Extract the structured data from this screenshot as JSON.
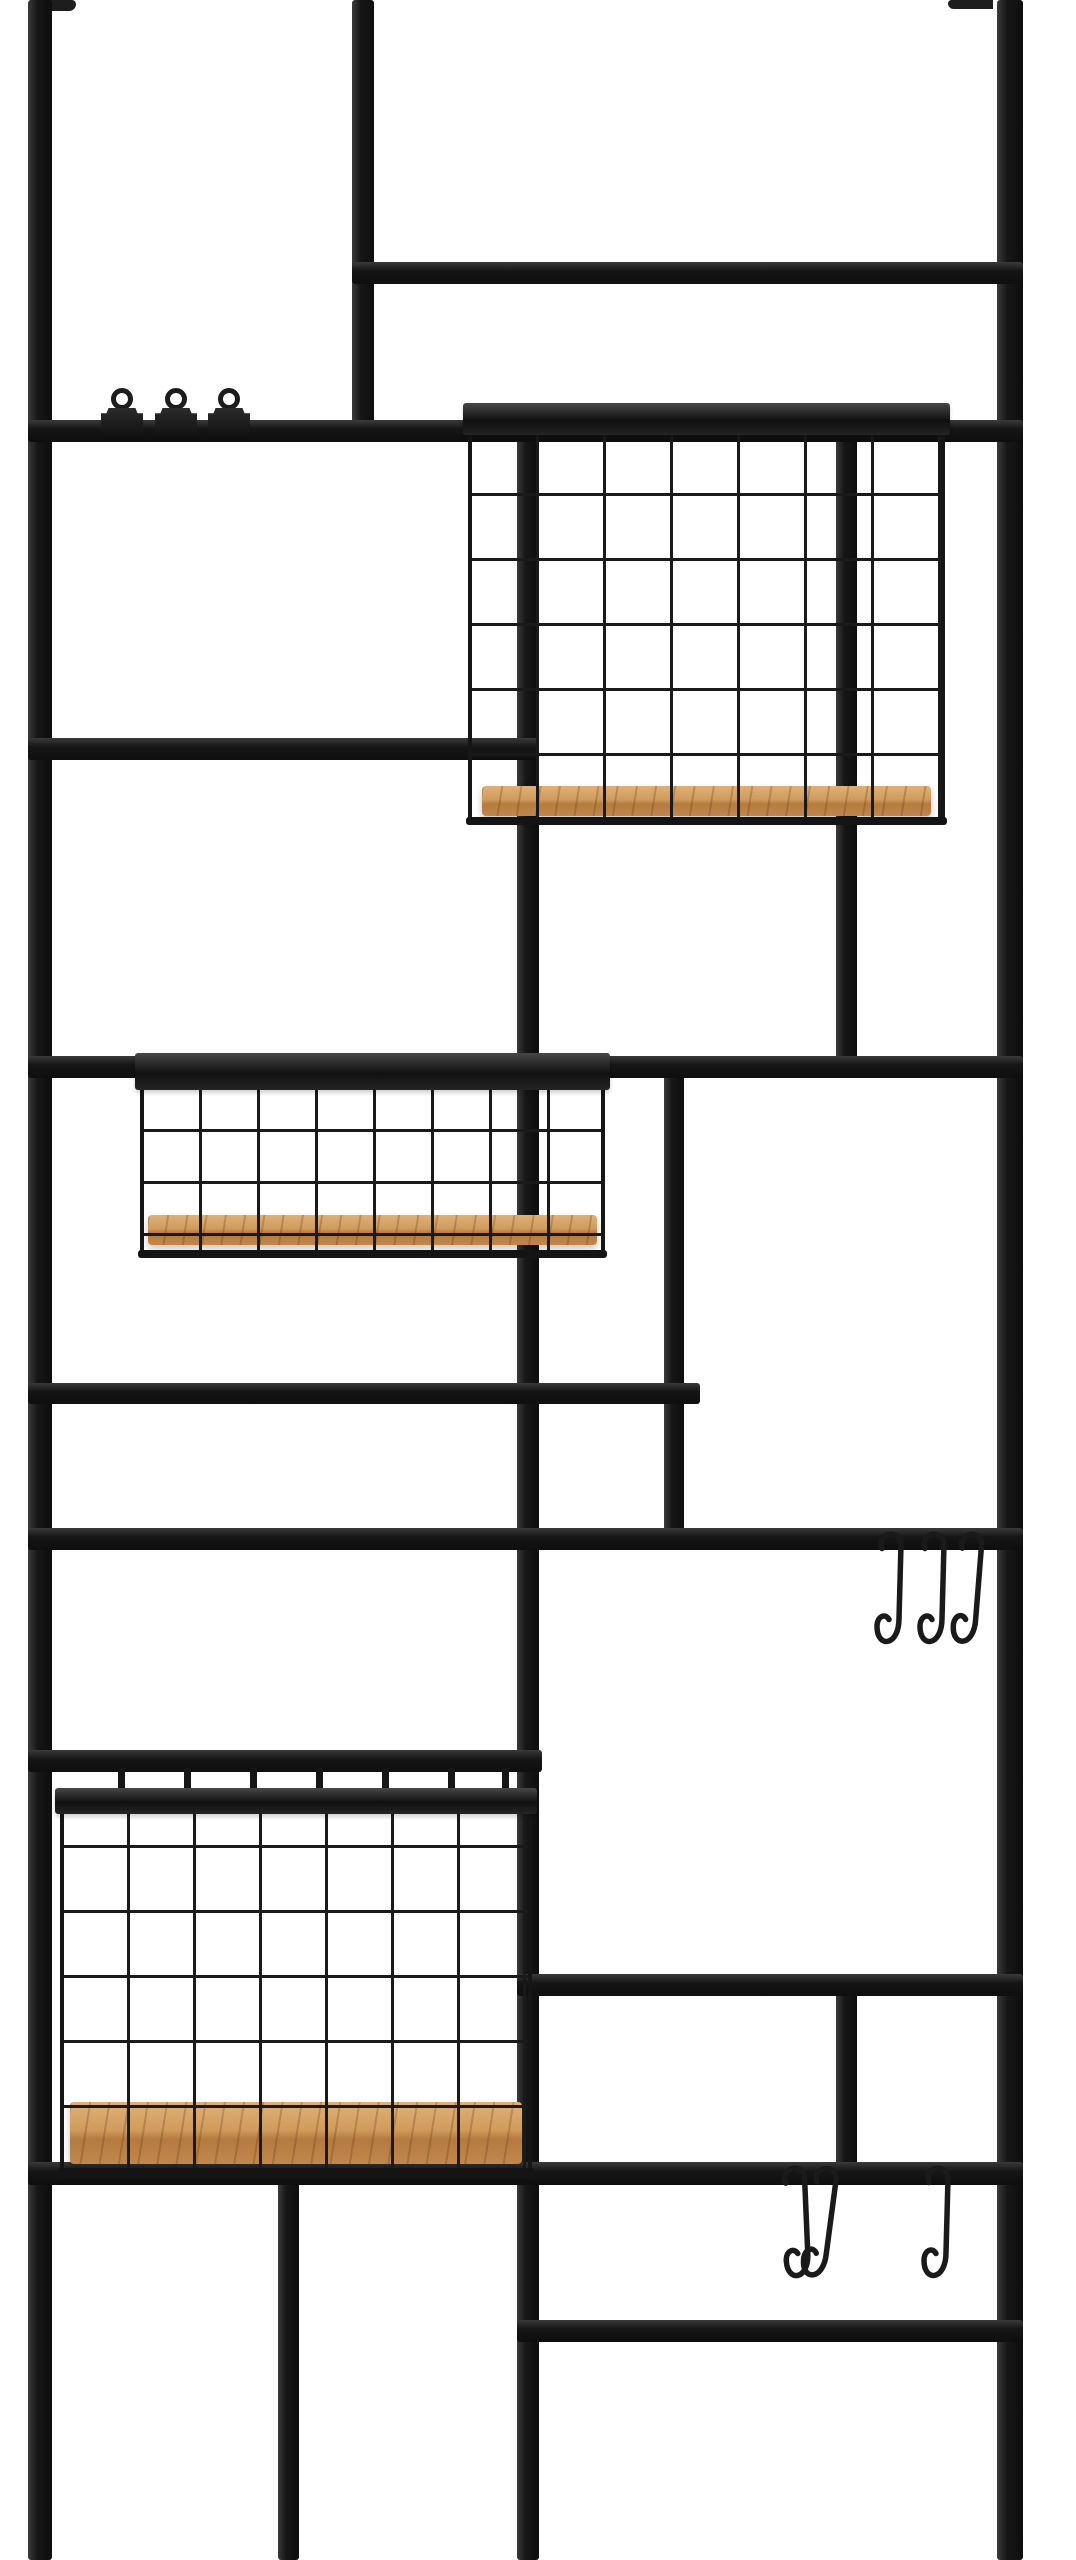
{
  "photo": {
    "description": "Product photo: black metal wall-mounted grid organizer panel with three wire baskets with wooden bases, three bulldog clips on an upper rail, three S-hooks on a middle rail and three S-hooks on a lower rail, on a plain white background",
    "background": "#ffffff",
    "canvas": {
      "w": 1076,
      "h": 2560
    },
    "colors": {
      "metal_highlight": "#3a3a3a",
      "metal_base": "#161616",
      "metal_shadow": "#0e0e0e",
      "wire": "#1a1a1a",
      "wood_light": "#e0b077",
      "wood_mid": "#cf9c5c",
      "wood_edge": "#b57a40",
      "wood_grain": "rgba(96,58,25,0.28)"
    },
    "counts": {
      "baskets": 3,
      "clips": 3,
      "s_hooks": 6,
      "mounting_brackets": 2
    },
    "brackets": [
      {
        "id": "mounting-bracket-left",
        "x": 30,
        "y": 0,
        "w": 46,
        "h": 11,
        "side": "left"
      },
      {
        "id": "mounting-bracket-right",
        "x": 948,
        "y": 0,
        "w": 45,
        "h": 9,
        "side": "right"
      }
    ],
    "uprights": [
      {
        "id": "upright-left",
        "x": 28,
        "w": 24,
        "y1": 0,
        "y2": 2560
      },
      {
        "id": "upright-right",
        "x": 997,
        "w": 26,
        "y1": 0,
        "y2": 2560
      },
      {
        "id": "upright-top-center",
        "x": 352,
        "w": 22,
        "y1": 0,
        "y2": 442
      },
      {
        "id": "upright-center-left",
        "x": 517,
        "w": 22,
        "y1": 430,
        "y2": 2560
      },
      {
        "id": "upright-mid-right",
        "x": 664,
        "w": 20,
        "y1": 1060,
        "y2": 1550
      },
      {
        "id": "upright-behind-top-basket",
        "x": 836,
        "w": 21,
        "y1": 430,
        "y2": 1072
      },
      {
        "id": "upright-lower-right",
        "x": 836,
        "w": 21,
        "y1": 1985,
        "y2": 2185
      },
      {
        "id": "upright-bottom-left",
        "x": 278,
        "w": 21,
        "y1": 2172,
        "y2": 2560
      }
    ],
    "rails": [
      {
        "id": "rail-upper-right",
        "x1": 352,
        "x2": 1023,
        "y": 262,
        "h": 22
      },
      {
        "id": "rail-clips",
        "x1": 28,
        "x2": 1023,
        "y": 420,
        "h": 22
      },
      {
        "id": "rail-left-mid",
        "x1": 28,
        "x2": 539,
        "y": 738,
        "h": 22
      },
      {
        "id": "rail-middle-basket",
        "x1": 28,
        "x2": 1023,
        "y": 1056,
        "h": 22
      },
      {
        "id": "rail-left-lower",
        "x1": 28,
        "x2": 700,
        "y": 1383,
        "h": 21
      },
      {
        "id": "rail-hooks-upper",
        "x1": 28,
        "x2": 1023,
        "y": 1528,
        "h": 22
      },
      {
        "id": "rail-bottom-basket",
        "x1": 28,
        "x2": 542,
        "y": 1750,
        "h": 22
      },
      {
        "id": "rail-right-upper",
        "x1": 517,
        "x2": 1023,
        "y": 1974,
        "h": 22
      },
      {
        "id": "rail-hooks-lower",
        "x1": 28,
        "x2": 1023,
        "y": 2162,
        "h": 23
      },
      {
        "id": "rail-right-lower",
        "x1": 517,
        "x2": 1023,
        "y": 2320,
        "h": 22
      }
    ],
    "baskets": [
      {
        "id": "wire-basket-top",
        "x": 468,
        "y": 403,
        "w": 477,
        "h": 422,
        "rim_h": 32,
        "cell_w": 67,
        "cell_h": 65,
        "row_off": 0,
        "wood": {
          "top": 383,
          "h": 30,
          "inset": 14
        },
        "bottom_wire_h": 8,
        "tabs": [],
        "tab_y": 0,
        "tab_h": 0
      },
      {
        "id": "wire-basket-middle",
        "x": 140,
        "y": 1053,
        "w": 465,
        "h": 205,
        "rim_h": 37,
        "cell_w": 58,
        "cell_h": 52,
        "row_off": -6,
        "wood": {
          "top": 162,
          "h": 30,
          "inset": 8
        },
        "bottom_wire_h": 8,
        "tabs": [],
        "tab_y": 0,
        "tab_h": 0
      },
      {
        "id": "wire-basket-bottom",
        "x": 60,
        "y": 1788,
        "w": 472,
        "h": 390,
        "rim_h": 26,
        "cell_w": 66,
        "cell_h": 65,
        "row_off": -27,
        "wood": {
          "top": 314,
          "h": 62,
          "inset": 10
        },
        "bottom_wire_h": 10,
        "tabs": [
          58,
          124,
          190,
          256,
          322,
          388,
          442
        ],
        "tab_y": -20,
        "tab_h": 24
      }
    ],
    "clips": {
      "id": "bulldog-clips",
      "rail": "rail-clips",
      "centers_x": [
        122,
        176,
        229
      ],
      "ring_d": 22,
      "ring_y": 388,
      "body_w": 42,
      "body_h": 26,
      "body_y": 408
    },
    "hook_groups": [
      {
        "id": "s-hooks-middle-right",
        "rail_y": 1528,
        "centers_x": [
          890,
          933,
          968
        ],
        "rot": [
          0,
          0,
          3
        ]
      },
      {
        "id": "s-hooks-bottom-right",
        "rail_y": 2162,
        "centers_x": [
          797,
          820,
          937
        ],
        "rot": [
          -4,
          6,
          0
        ]
      }
    ]
  }
}
